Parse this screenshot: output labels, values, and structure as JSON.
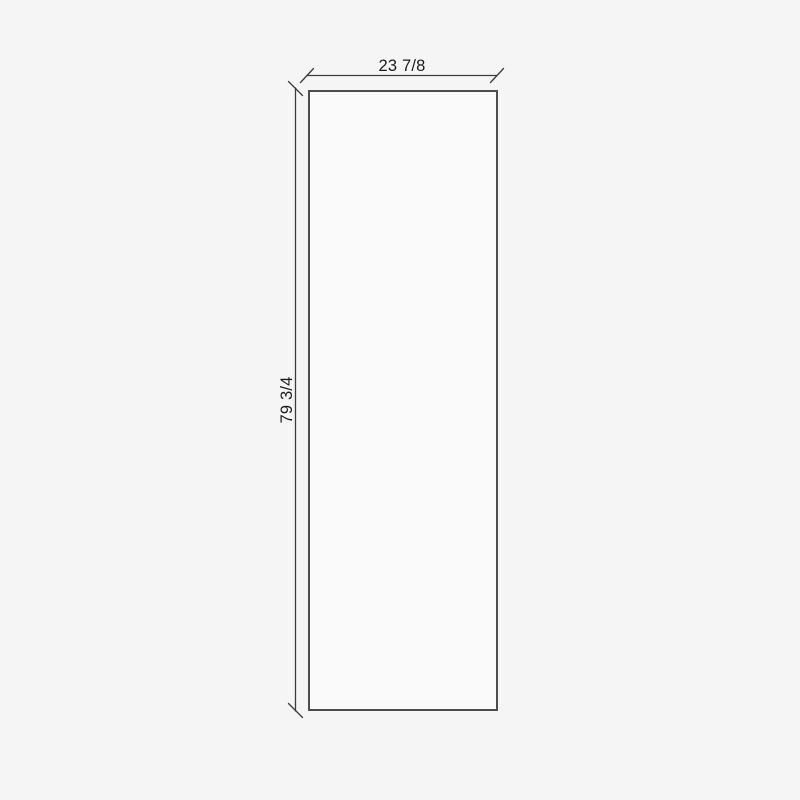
{
  "drawing": {
    "dimensions": {
      "width_label": "23 7/8",
      "height_label": "79 3/4"
    },
    "colors": {
      "background": "#f5f5f5",
      "panel_fill": "#fafafa",
      "panel_stroke": "#4d4d4d",
      "dimension_line": "#3c3c3c",
      "dimension_text": "#1c1c1c"
    }
  }
}
